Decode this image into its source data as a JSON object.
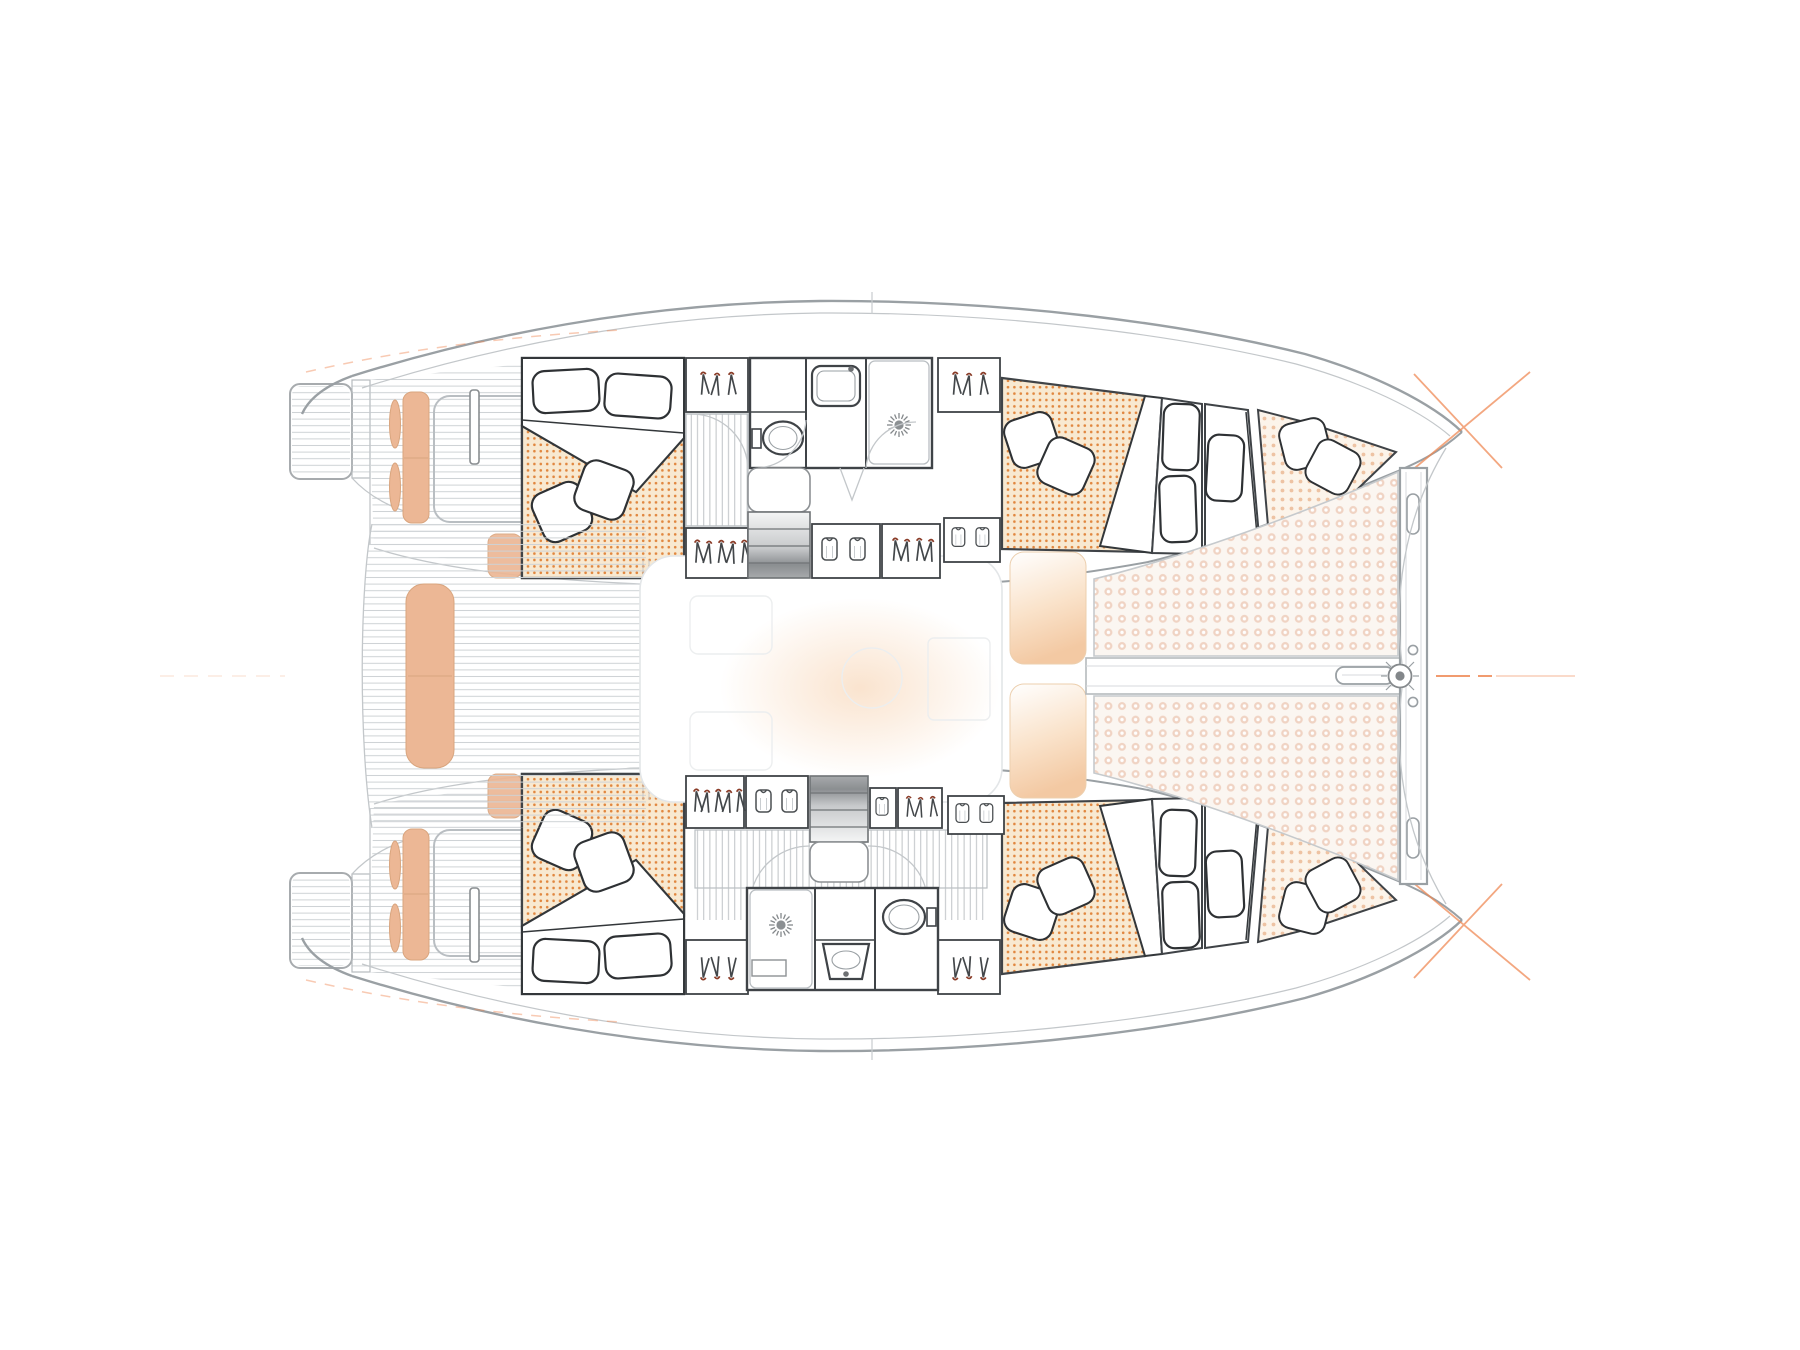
{
  "page": {
    "title": "Catamaran interior layout — top-view floor plan, 4 cabins / 2 heads",
    "background": "#ffffff",
    "view": "plan (top-down), bow to the right, sterns to the left"
  },
  "colors": {
    "accent": "#ef8a56",
    "cushion": "#ecb795",
    "cushion-line": "#d9a57e",
    "mattress-bg": "#f8e9d1",
    "mattress-dot": "#e1873f",
    "forepeak-bg": "#fcf4ea",
    "forepeak-dot": "#eec3a3",
    "tramp-bg": "#fbf6f1",
    "tramp-dot": "#f0d3c3",
    "outline": "#9aa0a4",
    "wall": "#3f4347",
    "light-line": "#c3c7ca",
    "hanger-hook": "#8a3c28",
    "pad-peach": "#f3c9a3"
  },
  "vessel": {
    "type": "sailing catamaran",
    "hulls": 2,
    "cabins": 4,
    "bathrooms": 2,
    "starboard_hull": {
      "aft_cabin": {
        "bed": "double",
        "bed_pillows": 2,
        "throw_pillows": 2,
        "mattress": "dotted orange"
      },
      "wardrobes": [
        {
          "kind": "hangers",
          "count": 3
        },
        {
          "kind": "hangers",
          "count": 5
        },
        {
          "kind": "shirts",
          "count": 2
        },
        {
          "kind": "hangers",
          "count": 4
        },
        {
          "kind": "shirts",
          "count": 2
        }
      ],
      "bathroom": {
        "toilet": 1,
        "sink": 1,
        "shower": "sunburst drain",
        "position": "toilet aft, shower forward"
      },
      "companionway": "stairs with gradient, landing inboard",
      "forward_cabin": {
        "berth_pillows": 3,
        "throw_pillows": 2,
        "mattress": "dotted orange"
      },
      "forepeak": {
        "throw_pillows": 2,
        "cushion": "light dotted"
      }
    },
    "port_hull": {
      "aft_cabin": {
        "bed": "double",
        "bed_pillows": 2,
        "throw_pillows": 2,
        "mattress": "dotted orange"
      },
      "wardrobes": [
        {
          "kind": "hangers",
          "count": 3
        },
        {
          "kind": "hangers",
          "count": 5
        },
        {
          "kind": "shirts",
          "count": 2
        },
        {
          "kind": "shirts",
          "count": 1
        },
        {
          "kind": "hangers",
          "count": 3
        },
        {
          "kind": "shirts",
          "count": 2
        }
      ],
      "bathroom": {
        "toilet": 1,
        "sink": 1,
        "shower": "sunburst drain",
        "position": "shower aft, toilet forward"
      },
      "companionway": "stairs with gradient, landing inboard",
      "forward_cabin": {
        "berth_pillows": 3,
        "throw_pillows": 2,
        "mattress": "dotted orange"
      },
      "forepeak": {
        "throw_pillows": 2,
        "cushion": "light dotted"
      }
    },
    "cockpit": {
      "central_bench_cushion": 1,
      "helm_seat_cushions": 2,
      "small_oval_cushions": 4,
      "corner_pads": 2,
      "deck": "horizontal teak planking",
      "swim_platforms": 2
    },
    "salon": {
      "style": "ghosted / faint",
      "front_lounge_pads": 2
    },
    "foredeck": {
      "trampoline_panels": 2,
      "texture": "dotted netting",
      "crossbeam": {
        "slots": 2,
        "holes": 2
      },
      "longeron_channel": 1,
      "forestay_hub": "circular fitting with spokes",
      "bow_marks": "orange crosshair hairlines at both bow tips and centerline"
    }
  }
}
